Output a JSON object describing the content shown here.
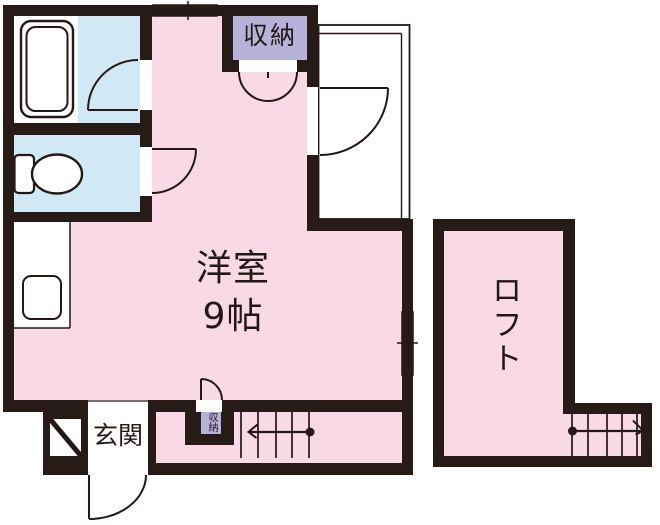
{
  "floorplan": {
    "rooms": {
      "main_room": {
        "label_line1": "洋室",
        "label_line2": "9帖"
      },
      "loft": {
        "label": "ロフト"
      },
      "entrance": {
        "label": "玄関"
      },
      "closet_top": {
        "label": "収納"
      },
      "closet_bottom": {
        "label": "収納"
      }
    },
    "colors": {
      "wall": "#261B17",
      "room_pink": "#F9D9E6",
      "wet_area_blue": "#D0E9F4",
      "closet_lavender": "#B6B2D9",
      "line": "#231815",
      "fixture_white": "#FFFFFF"
    }
  }
}
